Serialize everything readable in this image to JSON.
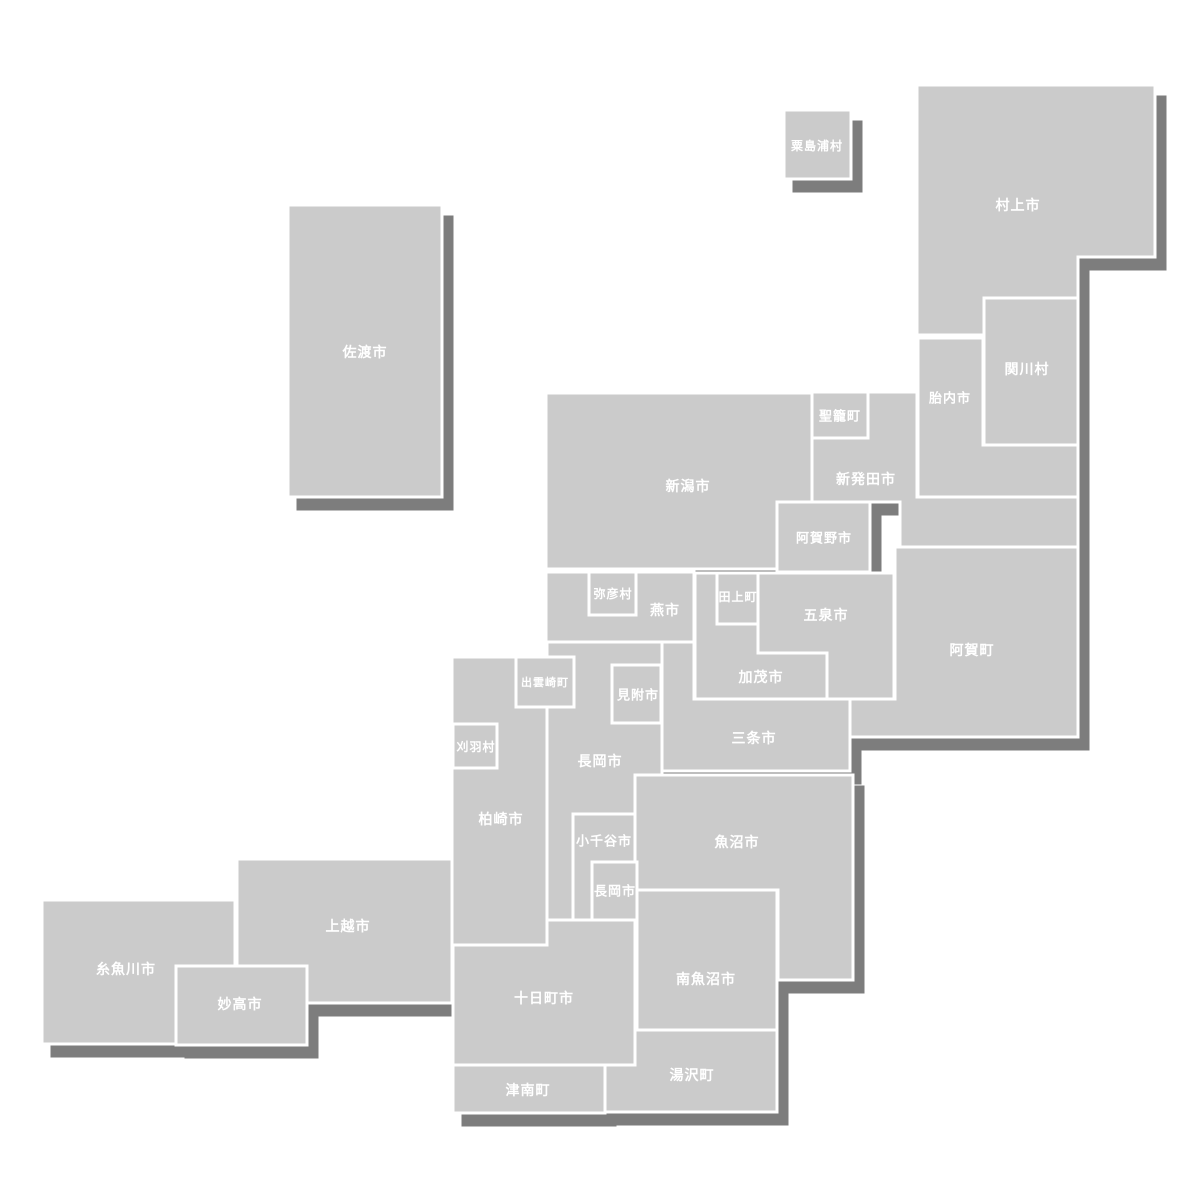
{
  "map": {
    "name": "niigata-prefecture-municipality-tile-map",
    "canvas": {
      "width": 1200,
      "height": 1200
    },
    "colors": {
      "background": "#ffffff",
      "tile_fill": "#cbcbcb",
      "tile_border": "#ffffff",
      "shadow": "#7d7d7d",
      "label": "#ffffff"
    },
    "style": {
      "tile_border_width": 3,
      "shadow_dx": 10,
      "shadow_dy": 12
    },
    "municipalities": [
      {
        "id": "sado-shi",
        "label": "佐渡市",
        "layer": "base",
        "shape": {
          "type": "rect",
          "x": 288,
          "y": 205,
          "w": 154,
          "h": 292
        },
        "label_x": 365,
        "label_y": 352,
        "font_size": 14
      },
      {
        "id": "awashimaura-mura",
        "label": "粟島浦村",
        "layer": "base",
        "shape": {
          "type": "rect",
          "x": 784,
          "y": 110,
          "w": 67,
          "h": 69
        },
        "label_x": 817,
        "label_y": 146,
        "font_size": 12
      },
      {
        "id": "murakami-shi",
        "label": "村上市",
        "layer": "base",
        "shape": {
          "type": "path",
          "d": "M917,85 H1155 V257 H1078 V298 H984 V335 H917 Z"
        },
        "label_x": 1018,
        "label_y": 205,
        "font_size": 14
      },
      {
        "id": "sekikawa-mura",
        "label": "関川村",
        "layer": "base",
        "shape": {
          "type": "rect",
          "x": 984,
          "y": 298,
          "w": 94,
          "h": 147
        },
        "label_x": 1027,
        "label_y": 369,
        "font_size": 14
      },
      {
        "id": "tainai-shi",
        "label": "胎内市",
        "layer": "base",
        "shape": {
          "type": "path",
          "d": "M918,338 H983 V445 H1078 V497 H918 Z"
        },
        "label_x": 950,
        "label_y": 398,
        "font_size": 13
      },
      {
        "id": "seiro-machi",
        "label": "聖籠町",
        "layer": "base",
        "shape": {
          "type": "rect",
          "x": 812,
          "y": 392,
          "w": 56,
          "h": 46
        },
        "label_x": 840,
        "label_y": 416,
        "font_size": 13
      },
      {
        "id": "shibata-shi",
        "label": "新発田市",
        "layer": "base",
        "shape": {
          "type": "path",
          "d": "M868,392 H917 V497 H1078 V547 H900 V502 H812 V438 H868 Z"
        },
        "label_x": 866,
        "label_y": 479,
        "font_size": 14
      },
      {
        "id": "niigata-shi",
        "label": "新潟市",
        "layer": "base",
        "shape": {
          "type": "path",
          "d": "M546,393 H812 V502 H777 V569 H546 Z"
        },
        "label_x": 688,
        "label_y": 486,
        "font_size": 14
      },
      {
        "id": "aga-machi",
        "label": "阿賀町",
        "layer": "base",
        "shape": {
          "type": "path",
          "d": "M895,547 H1078 V737 H850 V699 H895 Z"
        },
        "label_x": 972,
        "label_y": 650,
        "font_size": 14
      },
      {
        "id": "tsubame-shi",
        "label": "燕市",
        "layer": "base",
        "shape": {
          "type": "rect",
          "x": 546,
          "y": 572,
          "w": 148,
          "h": 70
        },
        "label_x": 665,
        "label_y": 610,
        "font_size": 14
      },
      {
        "id": "tagami-machi",
        "label": "田上町",
        "layer": "base",
        "shape": {
          "type": "rect",
          "x": 717,
          "y": 573,
          "w": 41,
          "h": 51
        },
        "label_x": 738,
        "label_y": 597,
        "font_size": 12
      },
      {
        "id": "gosen-shi",
        "label": "五泉市",
        "layer": "base",
        "shape": {
          "type": "path",
          "d": "M758,573 H894 V699 H827 V653 H758 Z"
        },
        "label_x": 826,
        "label_y": 615,
        "font_size": 14
      },
      {
        "id": "kamo-shi",
        "label": "加茂市",
        "layer": "base",
        "shape": {
          "type": "path",
          "d": "M695,573 H717 V624 H758 V653 H827 V699 H695 Z"
        },
        "label_x": 761,
        "label_y": 677,
        "font_size": 14
      },
      {
        "id": "sanjo-shi",
        "label": "三条市",
        "layer": "base",
        "shape": {
          "type": "path",
          "d": "M662,642 H694 V699 H850 V771 H662 Z"
        },
        "label_x": 754,
        "label_y": 738,
        "font_size": 14
      },
      {
        "id": "nagaoka-shi",
        "label": "長岡市",
        "layer": "base",
        "shape": {
          "type": "path",
          "d": "M547,642 H662 V775 H635 V920 H547 Z"
        },
        "label_x": 600,
        "label_y": 761,
        "font_size": 14
      },
      {
        "id": "kashiwazaki-shi",
        "label": "柏崎市",
        "layer": "base",
        "shape": {
          "type": "rect",
          "x": 452,
          "y": 657,
          "w": 95,
          "h": 288
        },
        "label_x": 501,
        "label_y": 819,
        "font_size": 14
      },
      {
        "id": "uonuma-shi",
        "label": "魚沼市",
        "layer": "base",
        "shape": {
          "type": "path",
          "d": "M635,775 H853 V980 H778 V890 H635 Z"
        },
        "label_x": 737,
        "label_y": 842,
        "font_size": 14
      },
      {
        "id": "yuzawa-machi",
        "label": "湯沢町",
        "layer": "base",
        "shape": {
          "type": "rect",
          "x": 605,
          "y": 1030,
          "w": 172,
          "h": 82
        },
        "label_x": 692,
        "label_y": 1075,
        "font_size": 14
      },
      {
        "id": "tokamachi-shi",
        "label": "十日町市",
        "layer": "base",
        "shape": {
          "type": "path",
          "d": "M547,920 H635 V1065 H453 V945 H547 Z"
        },
        "label_x": 544,
        "label_y": 998,
        "font_size": 14
      },
      {
        "id": "tsunan-machi",
        "label": "津南町",
        "layer": "base",
        "shape": {
          "type": "rect",
          "x": 453,
          "y": 1065,
          "w": 152,
          "h": 48
        },
        "label_x": 528,
        "label_y": 1090,
        "font_size": 14
      },
      {
        "id": "itoigawa-shi",
        "label": "糸魚川市",
        "layer": "base",
        "shape": {
          "type": "rect",
          "x": 42,
          "y": 900,
          "w": 193,
          "h": 144
        },
        "label_x": 126,
        "label_y": 969,
        "font_size": 14
      },
      {
        "id": "joetsu-shi",
        "label": "上越市",
        "layer": "base",
        "shape": {
          "type": "rect",
          "x": 237,
          "y": 859,
          "w": 215,
          "h": 144
        },
        "label_x": 348,
        "label_y": 926,
        "font_size": 14
      },
      {
        "id": "agano-shi",
        "label": "阿賀野市",
        "layer": "overlay",
        "shape": {
          "type": "rect",
          "x": 777,
          "y": 502,
          "w": 93,
          "h": 70
        },
        "label_x": 824,
        "label_y": 538,
        "font_size": 13
      },
      {
        "id": "yahiko-mura",
        "label": "弥彦村",
        "layer": "overlay",
        "shape": {
          "type": "rect",
          "x": 589,
          "y": 572,
          "w": 47,
          "h": 43
        },
        "label_x": 613,
        "label_y": 594,
        "font_size": 12
      },
      {
        "id": "mitsuke-shi",
        "label": "見附市",
        "layer": "overlay",
        "shape": {
          "type": "rect",
          "x": 612,
          "y": 665,
          "w": 49,
          "h": 58
        },
        "label_x": 638,
        "label_y": 695,
        "font_size": 13
      },
      {
        "id": "izumozaki-machi",
        "label": "出雲崎町",
        "layer": "overlay",
        "shape": {
          "type": "rect",
          "x": 516,
          "y": 657,
          "w": 58,
          "h": 50
        },
        "label_x": 545,
        "label_y": 683,
        "font_size": 11
      },
      {
        "id": "kariwa-mura",
        "label": "刈羽村",
        "layer": "overlay",
        "shape": {
          "type": "rect",
          "x": 453,
          "y": 724,
          "w": 44,
          "h": 44
        },
        "label_x": 476,
        "label_y": 747,
        "font_size": 12
      },
      {
        "id": "ojiya-shi",
        "label": "小千谷市",
        "layer": "overlay",
        "shape": {
          "type": "rect",
          "x": 573,
          "y": 814,
          "w": 62,
          "h": 106
        },
        "label_x": 604,
        "label_y": 841,
        "font_size": 13
      },
      {
        "id": "nagaoka-shi-enclave",
        "label": "長岡市",
        "layer": "overlay",
        "shape": {
          "type": "rect",
          "x": 592,
          "y": 862,
          "w": 45,
          "h": 58
        },
        "label_x": 615,
        "label_y": 891,
        "font_size": 13
      },
      {
        "id": "minamiuonuma-shi",
        "label": "南魚沼市",
        "layer": "overlay",
        "shape": {
          "type": "rect",
          "x": 637,
          "y": 890,
          "w": 140,
          "h": 140
        },
        "label_x": 706,
        "label_y": 979,
        "font_size": 14
      },
      {
        "id": "myoko-shi",
        "label": "妙高市",
        "layer": "overlay",
        "shape": {
          "type": "rect",
          "x": 176,
          "y": 966,
          "w": 131,
          "h": 79
        },
        "label_x": 240,
        "label_y": 1004,
        "font_size": 14
      }
    ]
  }
}
